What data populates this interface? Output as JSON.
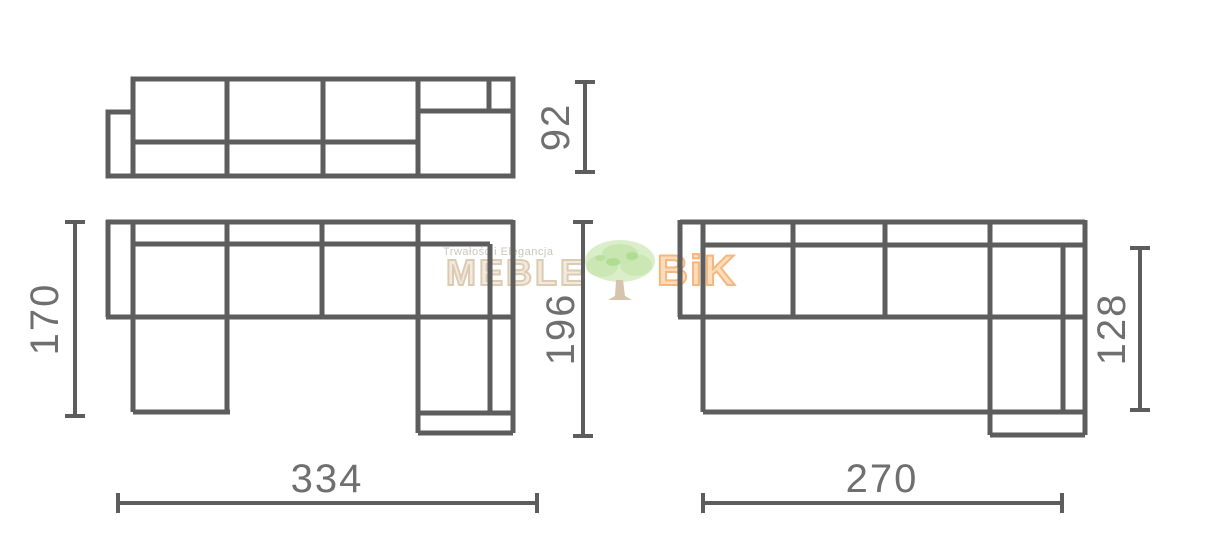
{
  "diagram": {
    "type": "furniture-dimension-drawing",
    "description": "Corner sofa technical drawings: front view and two top views with dimensions in cm",
    "line_color": "#5d5d5d",
    "dimension_text_color": "#6f6f6f",
    "dimensions": {
      "front_height": "92",
      "u_sofa_left_depth": "170",
      "u_sofa_total_depth": "196",
      "u_sofa_total_width": "334",
      "l_sofa_total_width": "270",
      "l_sofa_depth": "128"
    },
    "watermark": {
      "tagline": "Trwałość i Elegancja",
      "brand_left": "MEBLE",
      "brand_right": "BiK",
      "tree_icon": "tree-icon",
      "colors": {
        "brand_left": "#d9c6ab",
        "brand_right": "#f2ab69",
        "tree_foliage": "#cdeab6",
        "tagline": "#c9c6c2"
      }
    }
  }
}
